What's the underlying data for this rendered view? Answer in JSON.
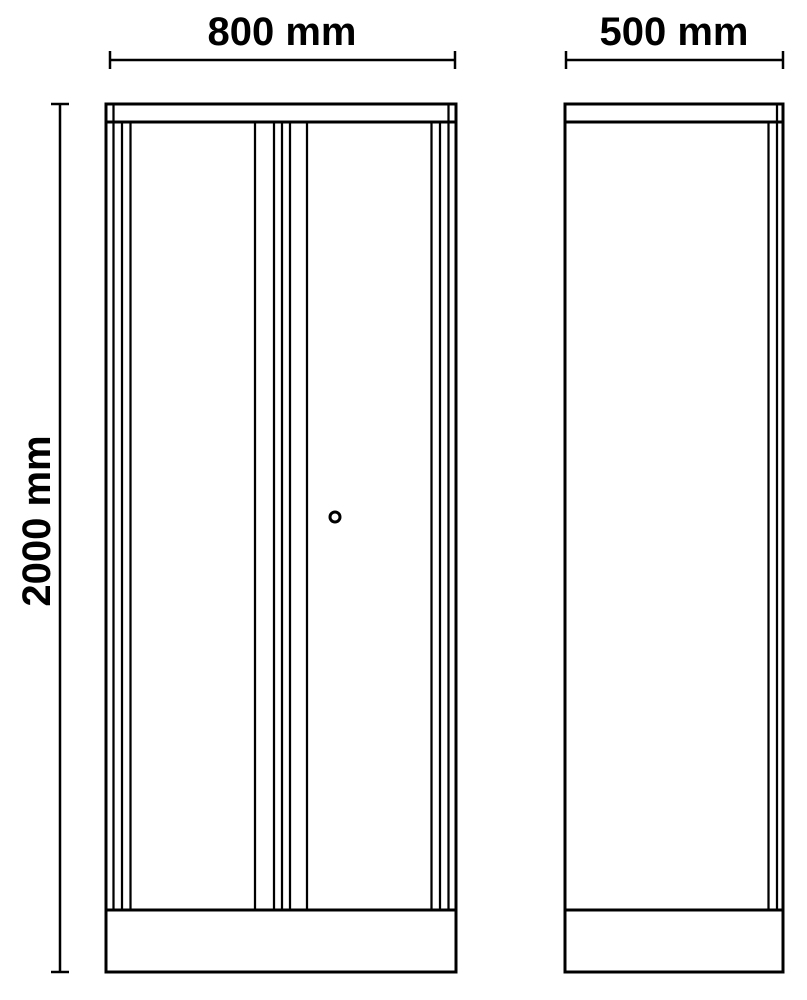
{
  "diagram": {
    "type": "technical-drawing-two-views",
    "background_color": "#ffffff",
    "line_color": "#000000",
    "labels": {
      "front_width": "800 mm",
      "side_depth": "500 mm",
      "height": "2000 mm"
    },
    "dimensions_mm": {
      "width": 800,
      "depth": 500,
      "height": 2000
    }
  }
}
